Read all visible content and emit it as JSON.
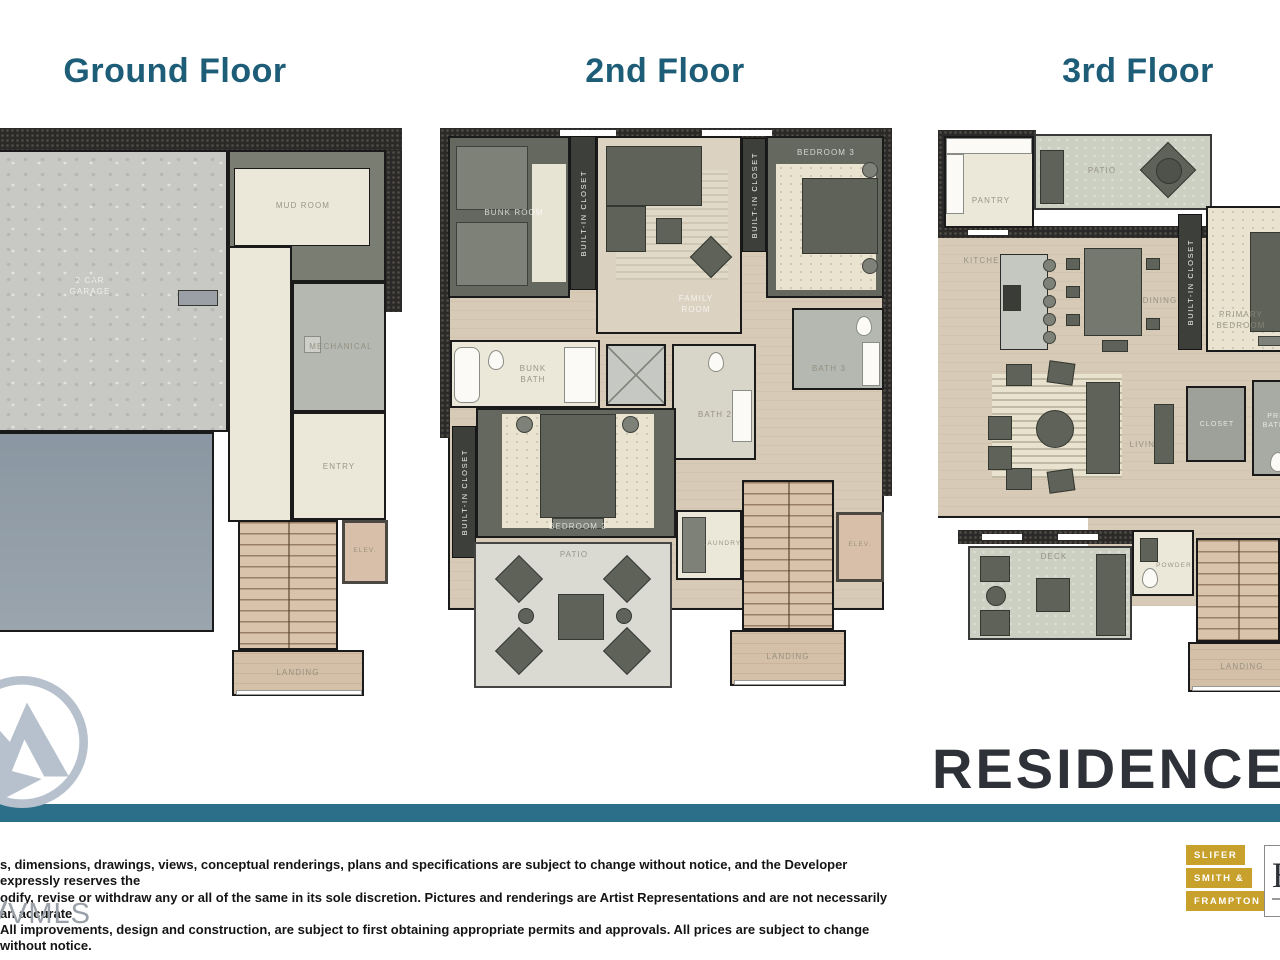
{
  "page": {
    "accent": "#1e5d78",
    "bar_color": "#2c6f88",
    "badge_gold": "#c8a12c"
  },
  "titles": {
    "ground": "Ground Floor",
    "second": "2nd Floor",
    "third": "3rd Floor"
  },
  "residence_label": "RESIDENCE",
  "ground": {
    "garage": "2 CAR GARAGE",
    "mud_room": "MUD ROOM",
    "mechanical": "MECHANICAL",
    "entry": "ENTRY",
    "elevator": "ELEV.",
    "landing": "LANDING"
  },
  "second": {
    "bunk_room": "BUNK ROOM",
    "built_in_closet": "BUILT-IN CLOSET",
    "family_room": "FAMILY ROOM",
    "bedroom3": "BEDROOM 3",
    "bath3": "BATH 3",
    "bunk_bath": "BUNK BATH",
    "bath2": "BATH 2",
    "bedroom2": "BEDROOM 2",
    "patio": "PATIO",
    "laundry": "LAUNDRY",
    "elevator": "ELEV.",
    "landing": "LANDING"
  },
  "third": {
    "patio": "PATIO",
    "pantry": "PANTRY",
    "kitchen": "KITCHEN",
    "dining": "DINING",
    "built_in_closet": "BUILT-IN CLOSET",
    "primary_bedroom": "PRIMARY BEDROOM",
    "living": "LIVING",
    "closet": "CLOSET",
    "primary_bath": "PRIMARY BATHROOM",
    "deck": "DECK",
    "powder": "POWDER",
    "landing": "LANDING"
  },
  "disclaimer": {
    "line1": "s, dimensions, drawings, views, conceptual renderings, plans and specifications are subject to change without notice, and the Developer expressly reserves the",
    "line2": "odify, revise or withdraw any or all of the same in its sole discretion. Pictures and renderings are Artist Representations and are not necessarily an accurate",
    "line3": "All improvements, design and construction, are subject to first obtaining appropriate permits and approvals. All prices are subject to change without notice."
  },
  "watermark": "VMLS",
  "brokerage": {
    "badge1": "SLIFER",
    "badge2": "SMITH &",
    "badge3": "FRAMPTON",
    "partial_letter": "E"
  }
}
